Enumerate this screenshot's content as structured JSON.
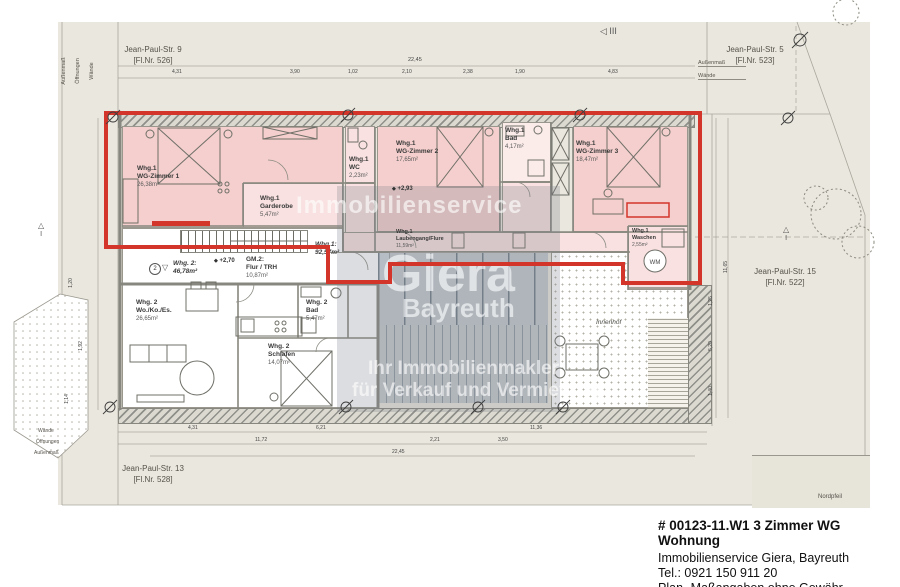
{
  "parcels": {
    "top_left": {
      "street": "Jean-Paul-Str. 9",
      "flnr": "[Fl.Nr. 526]"
    },
    "top_right": {
      "street": "Jean-Paul-Str. 5",
      "flnr": "[Fl.Nr. 523]"
    },
    "right": {
      "street": "Jean-Paul-Str. 15",
      "flnr": "[Fl.Nr. 522]"
    },
    "bottom": {
      "street": "Jean-Paul-Str. 13",
      "flnr": "[Fl.Nr. 528]"
    }
  },
  "margin_labels": {
    "aussenmass": "Außenmaß",
    "oeffnungen": "Öffnungen",
    "waende": "Wände"
  },
  "rooms": {
    "wg_zimmer1": {
      "unit": "Whg.1",
      "name": "WG-Zimmer 1",
      "area": "26,38m²"
    },
    "garderobe": {
      "unit": "Whg.1",
      "name": "Garderobe",
      "area": "5,47m²"
    },
    "wc": {
      "unit": "Whg.1",
      "name": "WC",
      "area": "2,23m²"
    },
    "wg_zimmer2": {
      "unit": "Whg.1",
      "name": "WG-Zimmer 2",
      "area": "17,65m²"
    },
    "bad1": {
      "unit": "Whg.1",
      "name": "Bad",
      "area": "4,17m²"
    },
    "wg_zimmer3": {
      "unit": "Whg.1",
      "name": "WG-Zimmer 3",
      "area": "18,47m²"
    },
    "laubengang": {
      "unit": "Whg.1",
      "name": "Laubengang/Flure",
      "area": "11,59m²"
    },
    "waschen": {
      "unit": "Whg.1",
      "name": "Waschen",
      "area": "2,55m²"
    },
    "whg1_total": {
      "unit": "Whg.1:",
      "area": "92,57m²"
    },
    "whg2_total": {
      "unit": "Whg. 2:",
      "area": "46,78m²"
    },
    "wohnen2": {
      "unit": "Whg. 2",
      "name": "Wo./Ko./Es.",
      "area": "26,65m²"
    },
    "bad2": {
      "unit": "Whg. 2",
      "name": "Bad",
      "area": "5,47m²"
    },
    "schlafen2": {
      "unit": "Whg. 2",
      "name": "Schlafen",
      "area": "14,07m²"
    },
    "gm2": {
      "unit": "GM.2:",
      "name": "Flur / TRH",
      "area": "10,87m²"
    }
  },
  "levels": {
    "hall": "+2,70",
    "corridor": "+2,93"
  },
  "innenhof_label": "Innenhof",
  "wm_label": "WM",
  "markers": {
    "unit2": "2",
    "triangle_down": "▽",
    "triangle_up": "△",
    "roman_one": "I",
    "section": "◁ III",
    "diamond": "◆"
  },
  "dims": {
    "top_total": "22,45",
    "top_segs": [
      "4,31",
      "3,90",
      "1,02",
      "2,10",
      "2,38",
      "1,90",
      "4,83"
    ],
    "bottom_segs_row1": [
      "4,31",
      "6,21",
      "11,36"
    ],
    "bottom_segs_row2": [
      "11,72",
      "2,21",
      "3,50"
    ],
    "bottom_total": "22,45",
    "right_total": "11,65",
    "right_segs": [
      "1,25",
      "5,20",
      "1,40"
    ],
    "left_segs": [
      "1,20",
      "1,92",
      "1,14"
    ]
  },
  "watermark": {
    "line1": "Immobilienservice",
    "line2": "Giera",
    "line3": "Bayreuth",
    "line4": "Ihr Immobilienmakler",
    "line5": "für Verkauf und Vermietung"
  },
  "north": {
    "label": "Nordpfeil"
  },
  "caption": {
    "title": "# 00123-11.W1   3 Zimmer WG Wohnung",
    "line2": "Immobilienservice Giera, Bayreuth",
    "line3": "Tel.: 0921 150 911 20",
    "line4": "Plan- Maßangaben ohne Gewähr"
  },
  "colors": {
    "apartment_outline": "#d3352b",
    "room_fill": "#f4cfcd",
    "glass": "#9fb0bf",
    "parcel": "#eae7de"
  }
}
